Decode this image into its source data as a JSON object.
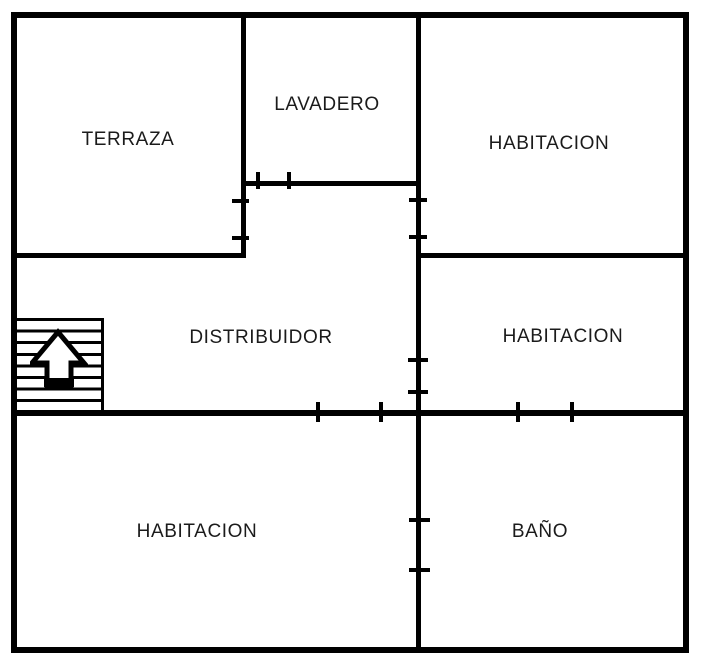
{
  "canvas": {
    "width": 713,
    "height": 669,
    "background": "#ffffff",
    "wall_color": "#000000",
    "text_color": "#1b1b1b"
  },
  "rooms": {
    "terraza": {
      "label": "TERRAZA"
    },
    "lavadero": {
      "label": "LAVADERO"
    },
    "habitacion_top_right": {
      "label": "HABITACION"
    },
    "distribuidor": {
      "label": "DISTRIBUIDOR"
    },
    "habitacion_mid_right": {
      "label": "HABITACION"
    },
    "habitacion_bottom_left": {
      "label": "HABITACION"
    },
    "bano": {
      "label": "BAÑO"
    }
  },
  "icons": {
    "stairs": "stairs-up-arrow-icon"
  }
}
